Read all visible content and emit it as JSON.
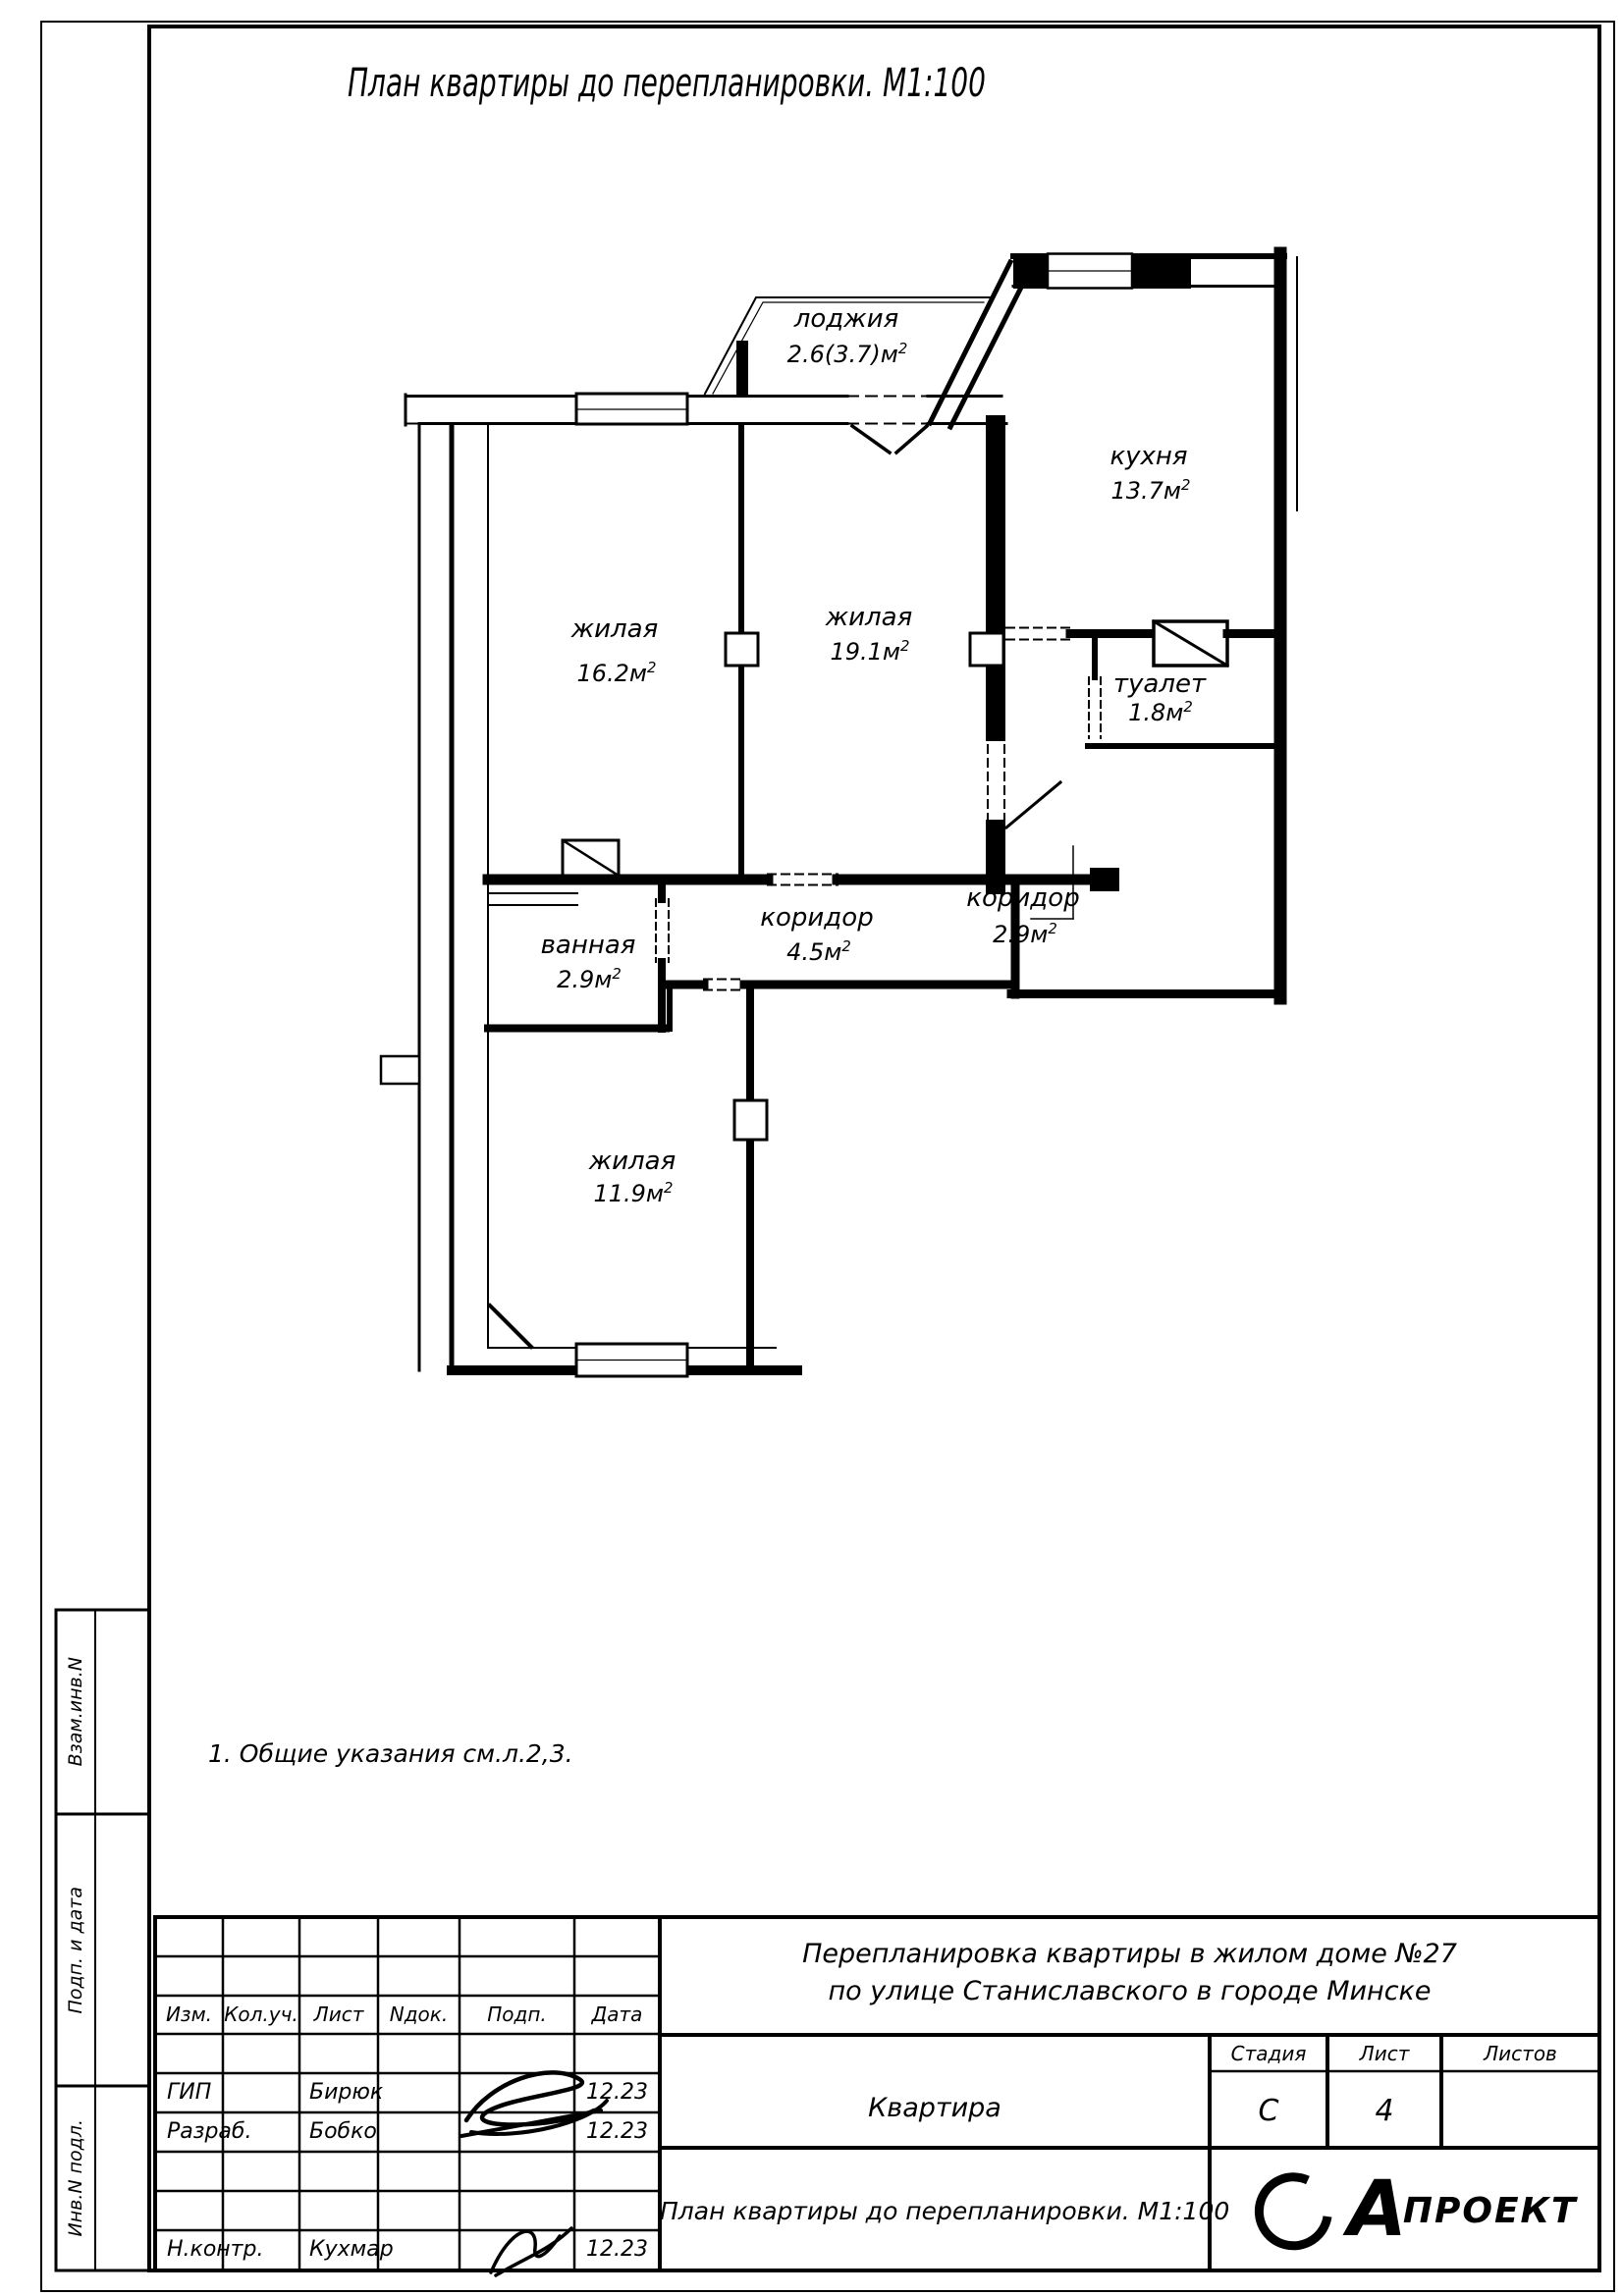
{
  "sheet": {
    "title": "План квартиры до перепланировки. М1:100",
    "note": "1.  Общие указания см.л.2,3."
  },
  "plan": {
    "sup": "2",
    "rooms": [
      {
        "label": "лоджия",
        "area": "2.6(3.7)м"
      },
      {
        "label": "кухня",
        "area": "13.7м"
      },
      {
        "label": "жилая",
        "area": "16.2м"
      },
      {
        "label": "жилая",
        "area": "19.1м"
      },
      {
        "label": "туалет",
        "area": "1.8м"
      },
      {
        "label": "ванная",
        "area": "2.9м"
      },
      {
        "label": "коридор",
        "area": "4.5м"
      },
      {
        "label": "коридор",
        "area": "2.9м"
      },
      {
        "label": "жилая",
        "area": "11.9м"
      }
    ]
  },
  "sidebar": {
    "labels": [
      "Взам.инв.N",
      "Подп. и дата",
      "Инв.N подл."
    ]
  },
  "titleblock": {
    "cols": [
      "Изм.",
      "Кол.уч.",
      "Лист",
      "Nдок.",
      "Подп.",
      "Дата"
    ],
    "rows": [
      {
        "role": "ГИП",
        "name": "Бирюк",
        "date": "12.23"
      },
      {
        "role": "Разраб.",
        "name": "Бобко",
        "date": "12.23"
      },
      {
        "role": "Н.контр.",
        "name": "Кухмар",
        "date": "12.23"
      }
    ],
    "project_line1": "Перепланировка квартиры в жилом доме  №27",
    "project_line2": "по улице Станиславского в городе Минске",
    "object": "Квартира",
    "stage_label": "Стадия",
    "sheet_label": "Лист",
    "sheets_label": "Листов",
    "stage": "С",
    "sheet_no": "4",
    "sheets_total": "",
    "drawing_title": "План квартиры до перепланировки. М1:100",
    "logo_letter": "А",
    "logo_text": "ПРОЕКТ"
  }
}
